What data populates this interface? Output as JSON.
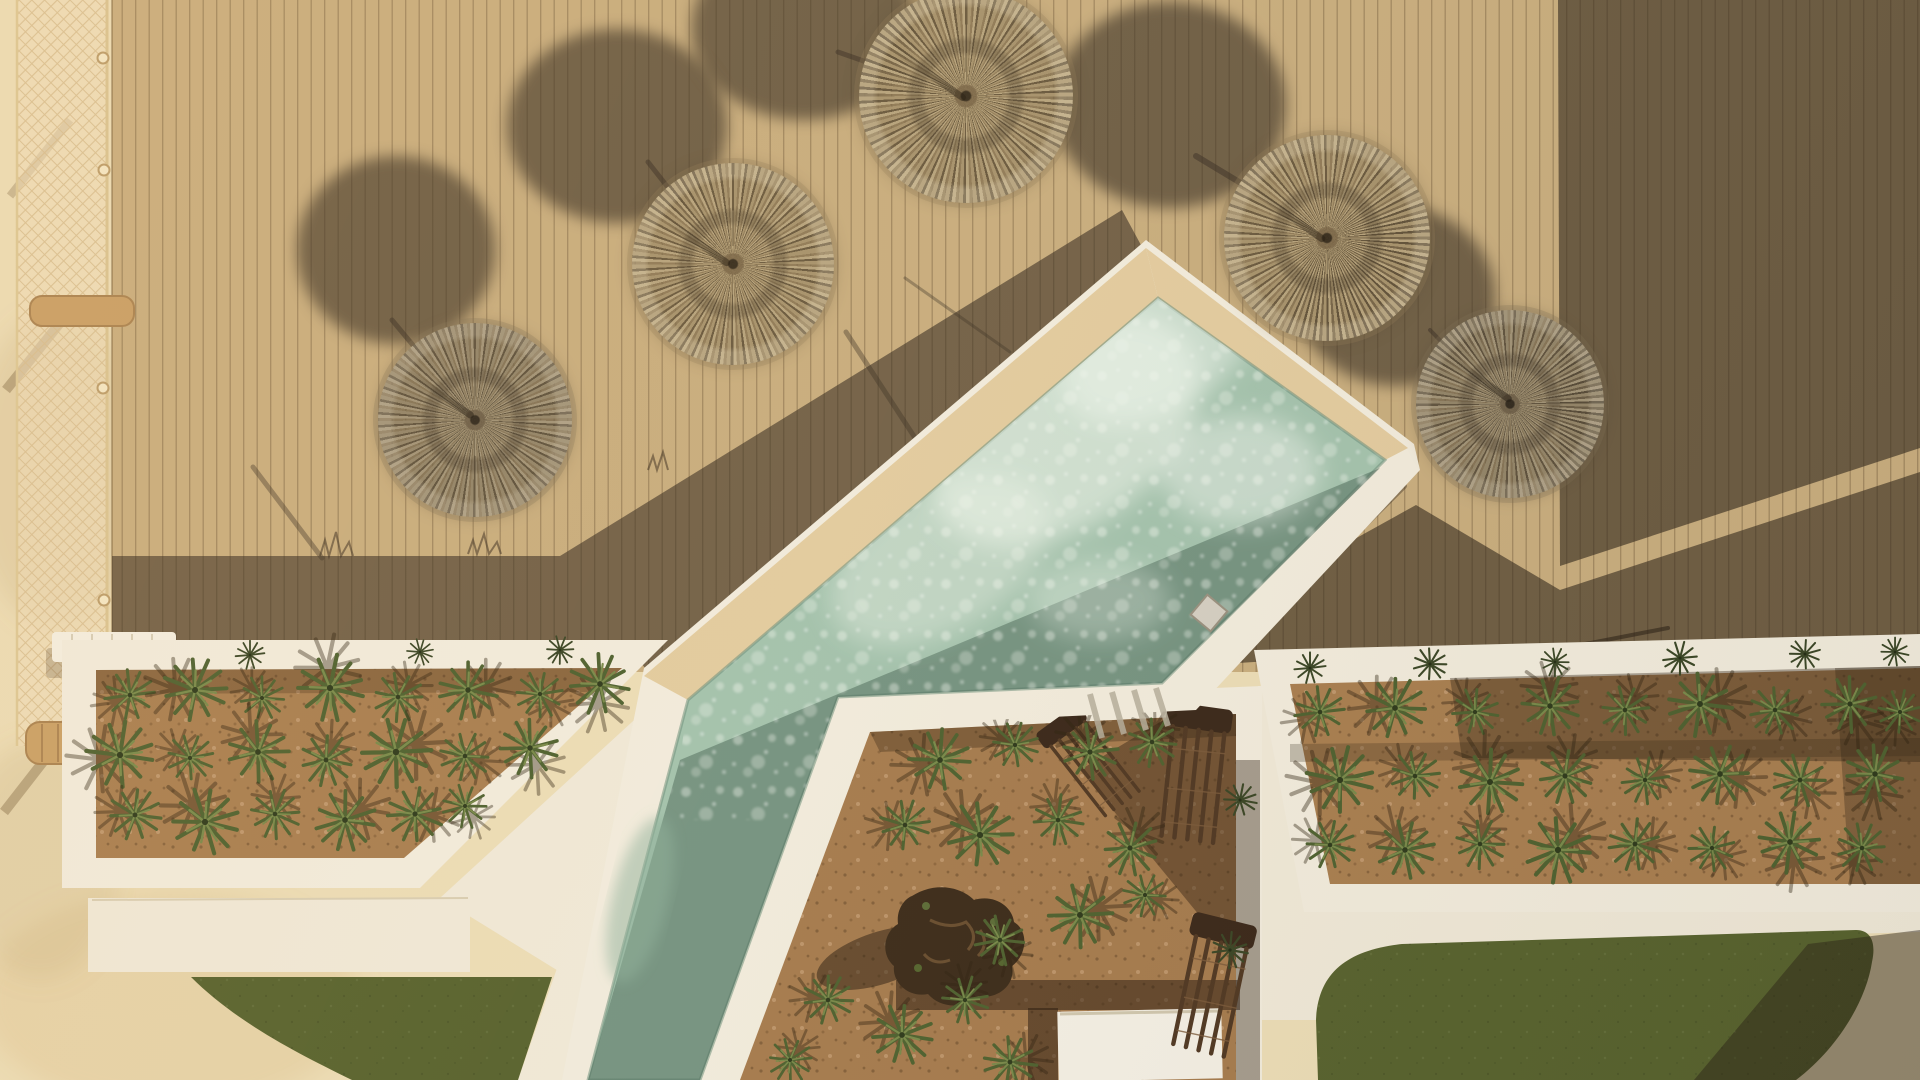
{
  "scene": {
    "description": "Aerial top-down drone photo of a resort pool terrace at golden hour: a sand-coloured timber deck with five round straw parasols casting long oval shadows, a diagonal sage-green pool with cream stone coping, agave planter beds framed in white stone, white walkways, two patches of lawn, wooden loungers and a building shadow falling across the right side.",
    "time_of_day": "low sun, long shadows",
    "palette": {
      "deck": "#c8ad7e",
      "deck_shadow": "#574939",
      "stone": "#ebdcb6",
      "white_wall": "#f1ebdc",
      "pool_coping": "#e2cb9f",
      "water_lit": "#a3c2ad",
      "water_shadow": "#7d9e8b",
      "foam": "#f2f7ef",
      "soil": "#a87e50",
      "soil_shadow": "#5e452f",
      "grass": "#57622e",
      "straw": "#9c8662",
      "plant_green": "#4e6130"
    },
    "umbrellas": [
      {
        "cx": 966,
        "cy": 96,
        "r": 107,
        "rot": 10,
        "tone": "light"
      },
      {
        "cx": 733,
        "cy": 264,
        "r": 101,
        "rot": 80,
        "tone": "light"
      },
      {
        "cx": 475,
        "cy": 420,
        "r": 97,
        "rot": 150,
        "tone": "dim"
      },
      {
        "cx": 1327,
        "cy": 238,
        "r": 103,
        "rot": 40,
        "tone": "light"
      },
      {
        "cx": 1510,
        "cy": 404,
        "r": 94,
        "rot": 200,
        "tone": "dim"
      }
    ],
    "umbrella_shadows": [
      {
        "cx": 804,
        "cy": 28,
        "rx": 112,
        "ry": 92
      },
      {
        "cx": 617,
        "cy": 126,
        "rx": 110,
        "ry": 97
      },
      {
        "cx": 396,
        "cy": 250,
        "rx": 99,
        "ry": 94
      },
      {
        "cx": 1170,
        "cy": 105,
        "rx": 116,
        "ry": 103
      },
      {
        "cx": 1396,
        "cy": 296,
        "rx": 99,
        "ry": 90
      }
    ],
    "features": {
      "umbrella_count": 5,
      "planter_beds": 3,
      "lawns": 2,
      "wooden_lounger_stacks": 3,
      "white_lounger": 1,
      "daybed_platform": 1,
      "rope_fence": 1,
      "pool_shape": "diagonal basin with narrow channel"
    }
  }
}
